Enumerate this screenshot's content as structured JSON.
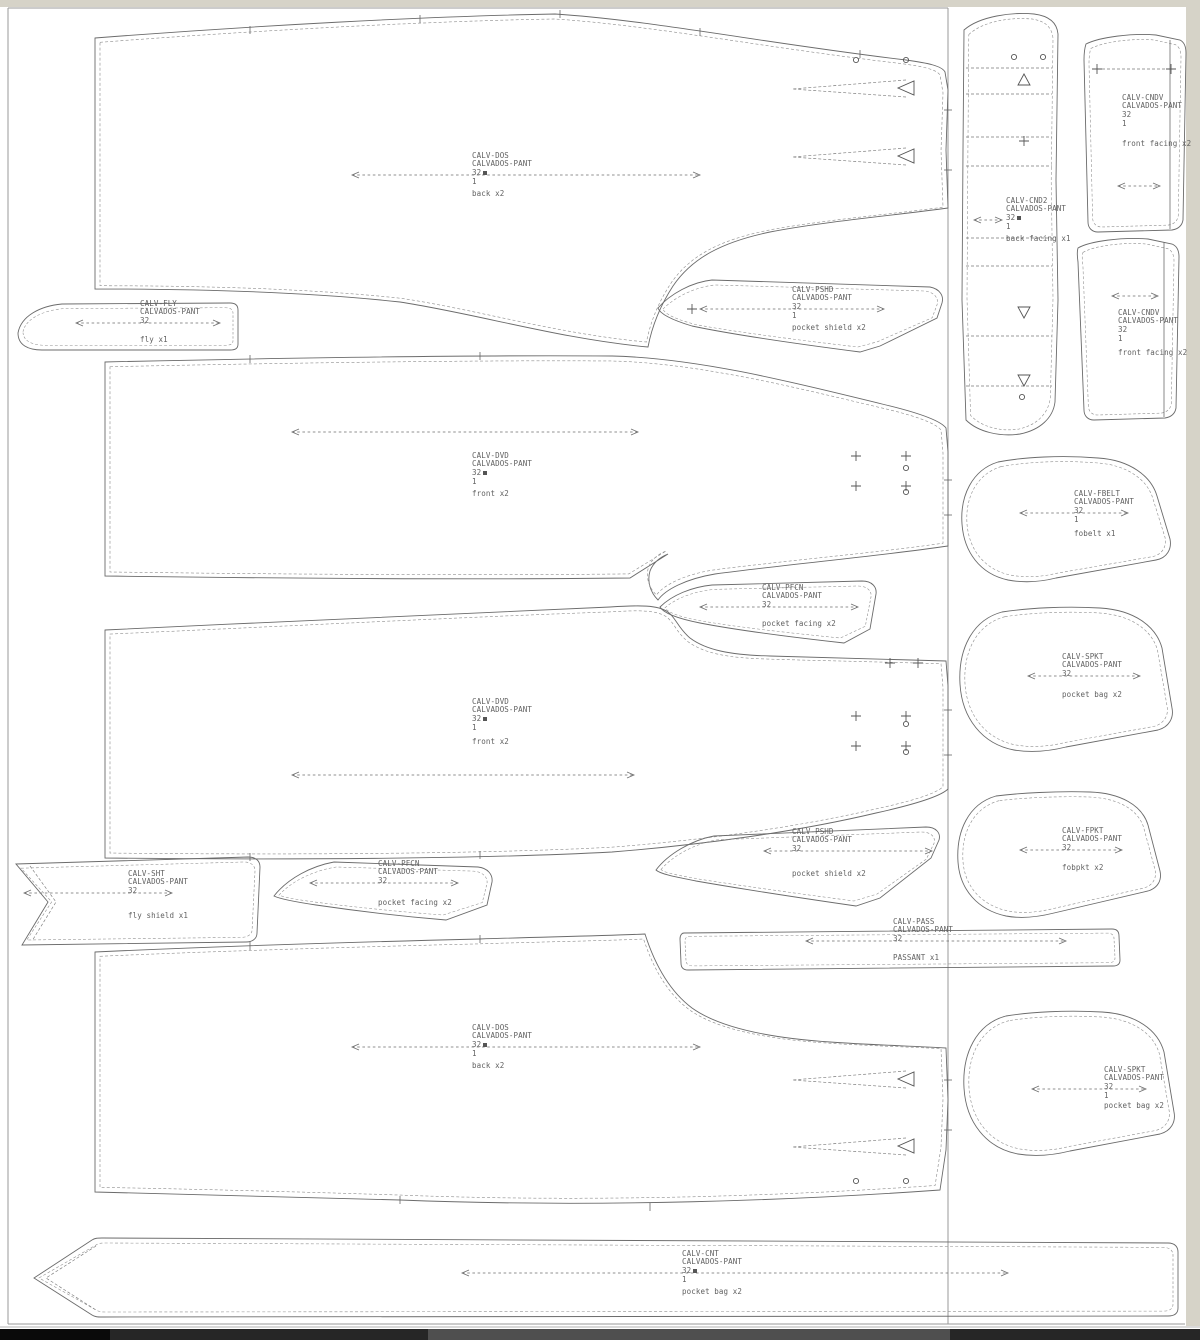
{
  "window": {
    "background": "#ffffff",
    "chrome_color": "#d6d3c8",
    "frame_color": "#9a9a9a"
  },
  "marker": {
    "product": "CALVADOS-PANT",
    "size": "32"
  },
  "pieces": [
    {
      "id": "back-upper",
      "code": "CALV-DOS",
      "product": "CALVADOS-PANT",
      "size": "32",
      "count": "1",
      "cut": "back x2"
    },
    {
      "id": "fly",
      "code": "CALV-FLY",
      "product": "CALVADOS-PANT",
      "size": "32",
      "count": "",
      "cut": "fly x1"
    },
    {
      "id": "pocket-shield-upper",
      "code": "CALV-PSHD",
      "product": "CALVADOS-PANT",
      "size": "32",
      "count": "1",
      "cut": "pocket shield x2"
    },
    {
      "id": "front-upper",
      "code": "CALV-DVD",
      "product": "CALVADOS-PANT",
      "size": "32",
      "count": "1",
      "cut": "front x2"
    },
    {
      "id": "back-facing",
      "code": "CALV-CND2",
      "product": "CALVADOS-PANT",
      "size": "32",
      "count": "1",
      "cut": "back facing x1"
    },
    {
      "id": "front-facing-top",
      "code": "CALV-CNDV",
      "product": "CALVADOS-PANT",
      "size": "32",
      "count": "1",
      "cut": "front facing x2"
    },
    {
      "id": "front-facing-right",
      "code": "CALV-CNDV",
      "product": "CALVADOS-PANT",
      "size": "32",
      "count": "1",
      "cut": "front facing x2"
    },
    {
      "id": "fob-belt",
      "code": "CALV-FBELT",
      "product": "CALVADOS-PANT",
      "size": "32",
      "count": "1",
      "cut": "fobelt x1"
    },
    {
      "id": "pocket-facing-mid",
      "code": "CALV-PFCN",
      "product": "CALVADOS-PANT",
      "size": "32",
      "count": "",
      "cut": "pocket facing x2"
    },
    {
      "id": "front-lower",
      "code": "CALV-DVD",
      "product": "CALVADOS-PANT",
      "size": "32",
      "count": "1",
      "cut": "front x2"
    },
    {
      "id": "pocket-bag-right",
      "code": "CALV-SPKT",
      "product": "CALVADOS-PANT",
      "size": "32",
      "count": "",
      "cut": "pocket bag x2"
    },
    {
      "id": "fob-pocket",
      "code": "CALV-FPKT",
      "product": "CALVADOS-PANT",
      "size": "32",
      "count": "",
      "cut": "fobpkt x2"
    },
    {
      "id": "pocket-shield-lower",
      "code": "CALV-PSHD",
      "product": "CALVADOS-PANT",
      "size": "32",
      "count": "",
      "cut": "pocket shield x2"
    },
    {
      "id": "fly-shield",
      "code": "CALV-SHT",
      "product": "CALVADOS-PANT",
      "size": "32",
      "count": "",
      "cut": "fly shield x1"
    },
    {
      "id": "pocket-facing-lower",
      "code": "CALV-PFCN",
      "product": "CALVADOS-PANT",
      "size": "32",
      "count": "",
      "cut": "pocket facing x2"
    },
    {
      "id": "passant",
      "code": "CALV-PASS",
      "product": "CALVADOS-PANT",
      "size": "32",
      "count": "",
      "cut": "PASSANT x1"
    },
    {
      "id": "back-lower",
      "code": "CALV-DOS",
      "product": "CALVADOS-PANT",
      "size": "32",
      "count": "1",
      "cut": "back x2"
    },
    {
      "id": "pocket-bag-bottom",
      "code": "CALV-SPKT",
      "product": "CALVADOS-PANT",
      "size": "32",
      "count": "1",
      "cut": "pocket bag x2"
    },
    {
      "id": "waistband",
      "code": "CALV-CNT",
      "product": "CALVADOS-PANT",
      "size": "32",
      "count": "1",
      "cut": "pocket bag x2"
    }
  ],
  "symbols": {
    "grainline": "double-headed dashed arrow",
    "dart": "hollow triangle",
    "drill_hole": "small circle",
    "match_mark": "plus cross",
    "size_marker": "small filled square"
  },
  "taskbar": {
    "segments": [
      "#0a0a0a",
      "#262626",
      "#4f4f4f",
      "#262626"
    ]
  }
}
